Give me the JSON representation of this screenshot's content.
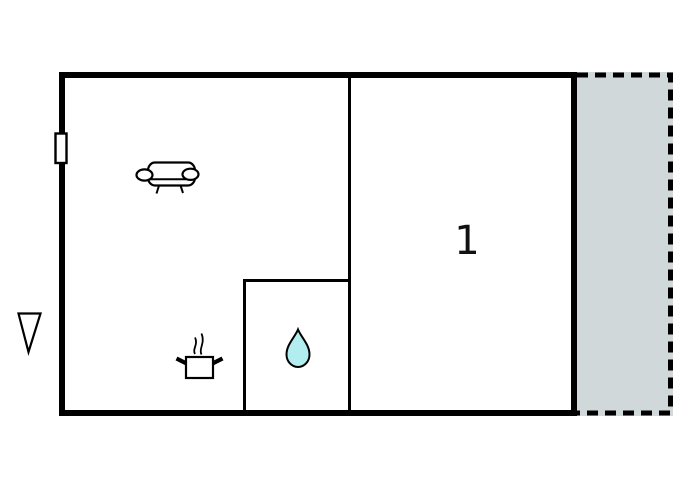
{
  "floor_plan": {
    "room_label": "1"
  },
  "icons": {
    "sofa": "sofa-icon",
    "cooking_pot": "cooking-pot-icon",
    "water_drop": "water-drop-icon",
    "direction_triangle": "north-arrow-icon",
    "window": "window-icon"
  },
  "colors": {
    "wall": "#000000",
    "terrace_fill": "#d1d8d9",
    "water_drop_fill": "#b2eef0",
    "background": "#ffffff",
    "label_text": "#111111"
  }
}
